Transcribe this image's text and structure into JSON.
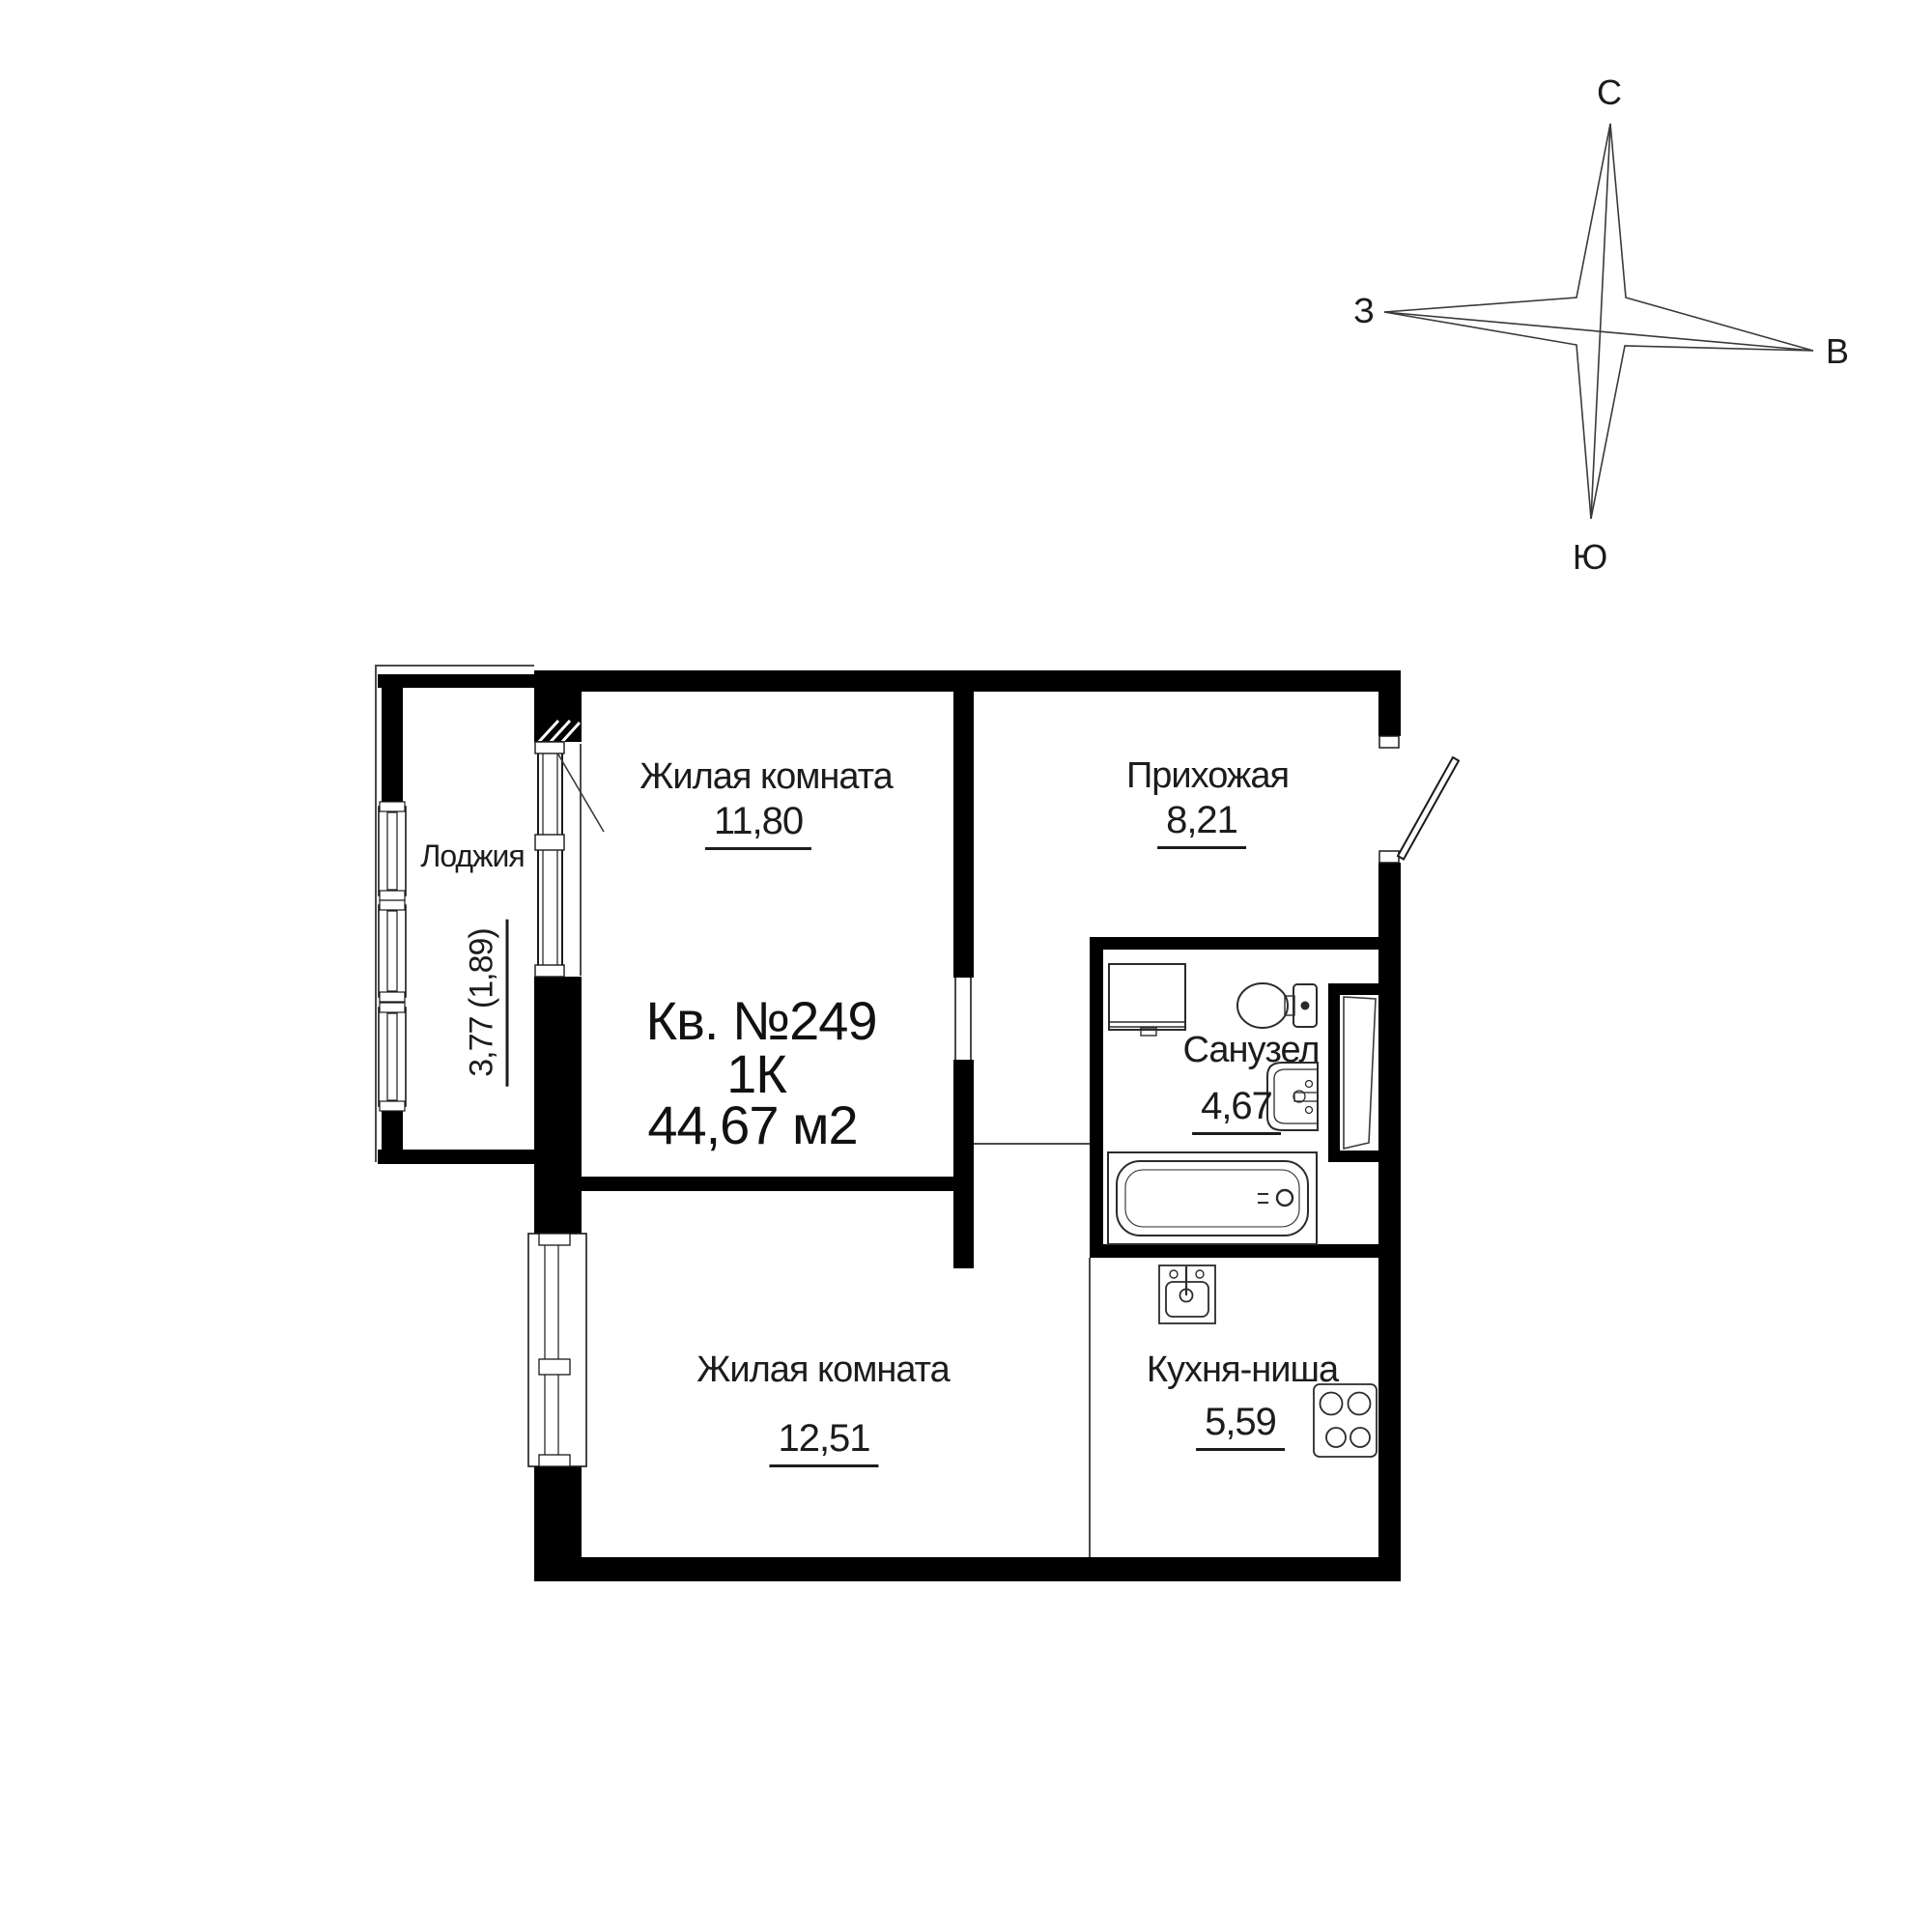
{
  "colors": {
    "background": "#ffffff",
    "walls": "#000000",
    "thin_lines": "#4a4a4a",
    "fixtures": "#2b2b2b",
    "text": "#1c1c1c"
  },
  "apartment": {
    "number": "Кв. №249",
    "type": "1К",
    "total_area": "44,67 м2"
  },
  "rooms": [
    {
      "name": "Жилая комната",
      "area": "11,80"
    },
    {
      "name": "Прихожая",
      "area": "8,21"
    },
    {
      "name": "Санузел",
      "area": "4,67"
    },
    {
      "name": "Жилая комната",
      "area": "12,51"
    },
    {
      "name": "Кухня-ниша",
      "area": "5,59"
    },
    {
      "name": "Лоджия",
      "area": "3,77 (1,89)"
    }
  ],
  "compass": {
    "north": "С",
    "south": "Ю",
    "west": "З",
    "east": "В"
  }
}
